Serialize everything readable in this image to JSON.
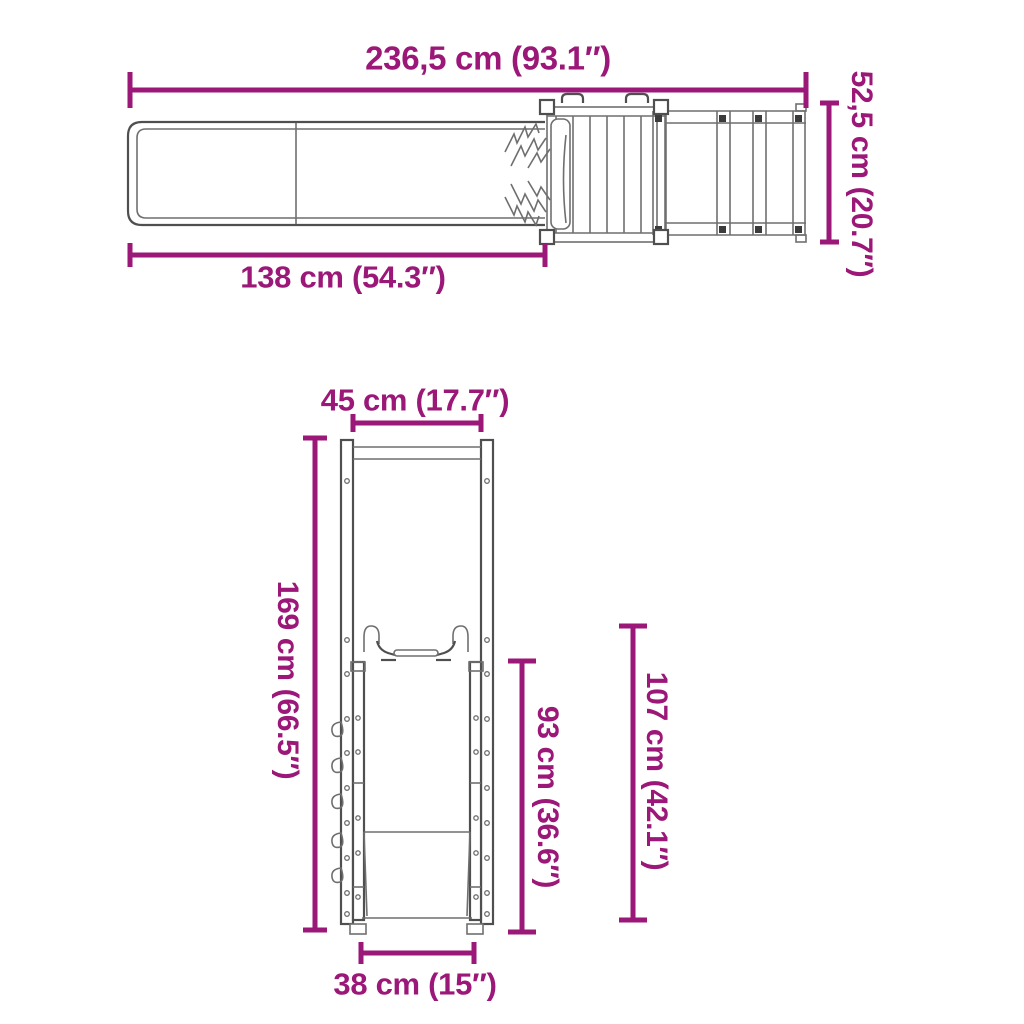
{
  "colors": {
    "dimension_accent": "#9B1778",
    "line": "#6f6f6f",
    "line_strong": "#4f4f4f",
    "line_dark": "#3b3b3b",
    "background": "#ffffff"
  },
  "top_view": {
    "dimensions": {
      "overall_width": "236,5 cm (93.1″)",
      "depth": "52,5 cm (20.7″)",
      "slide_length": "138 cm (54.3″)"
    }
  },
  "front_view": {
    "dimensions": {
      "top_width": "45 cm (17.7″)",
      "total_height": "169 cm (66.5″)",
      "slide_height": "93 cm (36.6″)",
      "frame_height": "107 cm (42.1″)",
      "base_width": "38 cm (15″)"
    }
  }
}
